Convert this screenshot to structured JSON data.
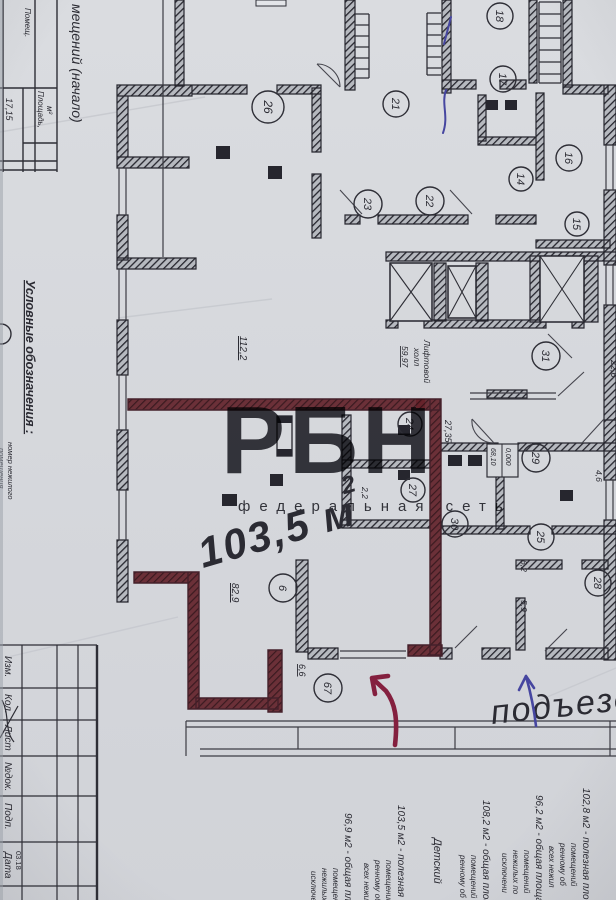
{
  "colors": {
    "paper": "#d6d8dc",
    "ink": "#26262e",
    "maroon": "#5a262e",
    "watermark_pink": "#f2b0be",
    "watermark_gray": "#b6b9bd",
    "hand_magenta": "#a62a66",
    "hand_blue": "#4646a0",
    "hand_darkred": "#84203f"
  },
  "sidebar": {
    "table_title": "мещений (начало)",
    "col_span_label": "Помещ.",
    "area_header_1": "Площадь,",
    "area_header_2": "м²",
    "area_value": "17,15",
    "legend_title": "Условные обозначения :",
    "legend_line_1": "номер нежилого",
    "legend_line_2": "помещения"
  },
  "titleblock": {
    "labels": [
      "Изм.",
      "Кол.",
      "Лист",
      "№док.",
      "Подп.",
      "Дата"
    ],
    "date": "03.18"
  },
  "watermark": {
    "text": "РБН",
    "subtext": "федеральная сеть"
  },
  "hand": {
    "area": "103,5 м",
    "area_sup": "2",
    "entrance": "подъезд"
  },
  "lift": {
    "line1": "Лифтовой",
    "line2": "холл",
    "value": "59,97"
  },
  "elevation": {
    "upper": "0,000",
    "lower": "68,10"
  },
  "rooms": [
    {
      "label": "26"
    },
    {
      "label": "21"
    },
    {
      "label": "18"
    },
    {
      "label": "17"
    },
    {
      "label": "23"
    },
    {
      "label": "22"
    },
    {
      "label": "16"
    },
    {
      "label": "14"
    },
    {
      "label": "15"
    },
    {
      "label": "31"
    },
    {
      "label": "24"
    },
    {
      "label": "27"
    },
    {
      "label": "29"
    },
    {
      "label": "30"
    },
    {
      "label": "25"
    },
    {
      "label": "28"
    },
    {
      "label": "6"
    },
    {
      "label": "67"
    }
  ],
  "dims": [
    {
      "value": "112,2"
    },
    {
      "value": "27,35"
    },
    {
      "value": "22,6"
    },
    {
      "value": "82,9"
    },
    {
      "value": "6,6"
    },
    {
      "value": "6,2"
    },
    {
      "value": "5,9"
    },
    {
      "value": "4,6"
    },
    {
      "value": "2,2"
    }
  ],
  "notes": [
    {
      "main": "102,8 м2 - полезная площадь",
      "subs": [
        "помещений",
        "ренному об",
        "всех нежил"
      ]
    },
    {
      "main": "96,2 м2 - общая площадь",
      "subs": [
        "помещений",
        "нежилых по",
        "исключени"
      ]
    },
    {
      "main": "108,2 м2 - общая площадь",
      "subs": [
        "помещений",
        "ренному об"
      ]
    },
    {
      "main": "Детский",
      "subs": []
    },
    {
      "main": "103,5 м2 - полезная площадь",
      "subs": [
        "помещений",
        "ренному об",
        "всех нежил"
      ]
    },
    {
      "main": "96,9 м2 - общая площадь",
      "subs": [
        "помещений",
        "нежилых по",
        "исключения"
      ]
    }
  ]
}
